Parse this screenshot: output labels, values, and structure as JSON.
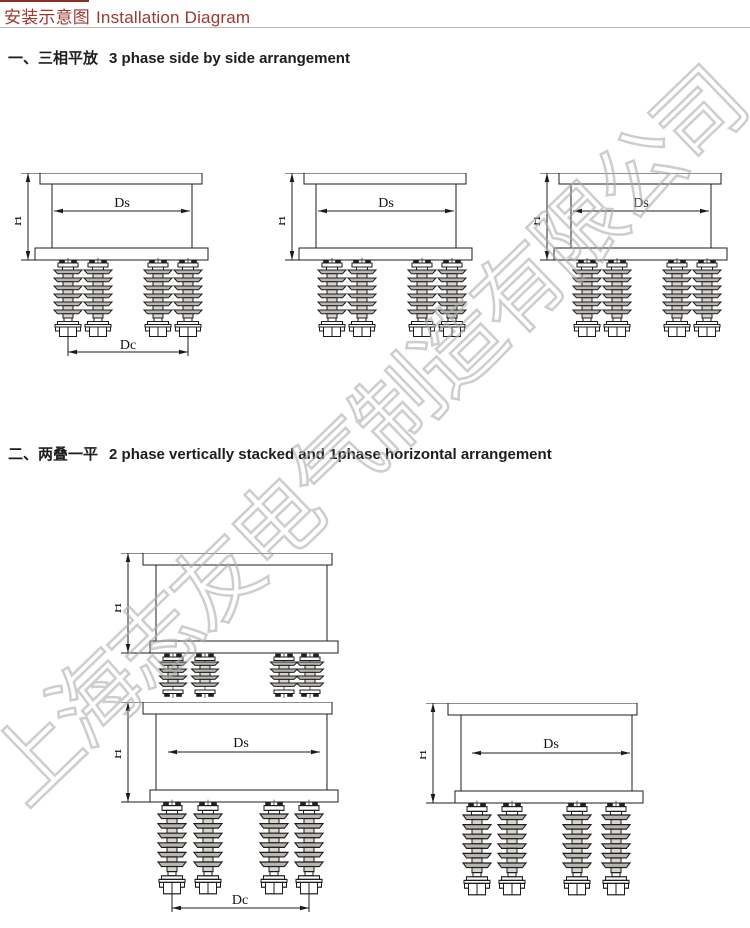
{
  "page": {
    "title_zh": "安装示意图",
    "title_en": "Installation Diagram"
  },
  "sections": [
    {
      "label_zh": "一、三相平放",
      "label_en": "3 phase side by side arrangement"
    },
    {
      "label_zh": "二、两叠一平",
      "label_en": "2 phase vertically stacked and 1phase horizontal arrangement"
    }
  ],
  "dims": {
    "h": "H",
    "ds": "Ds",
    "dc": "Dc"
  },
  "watermark": {
    "text": "上海志友电气制造有限公司"
  },
  "colors": {
    "accent_red": "#9a392f",
    "rule_red": "#8b3028",
    "divider_gray": "#b9b9b9",
    "line_black": "#1c1c1c",
    "fin_gray": "#b8b5af",
    "watermark_gray": "#acacac"
  }
}
